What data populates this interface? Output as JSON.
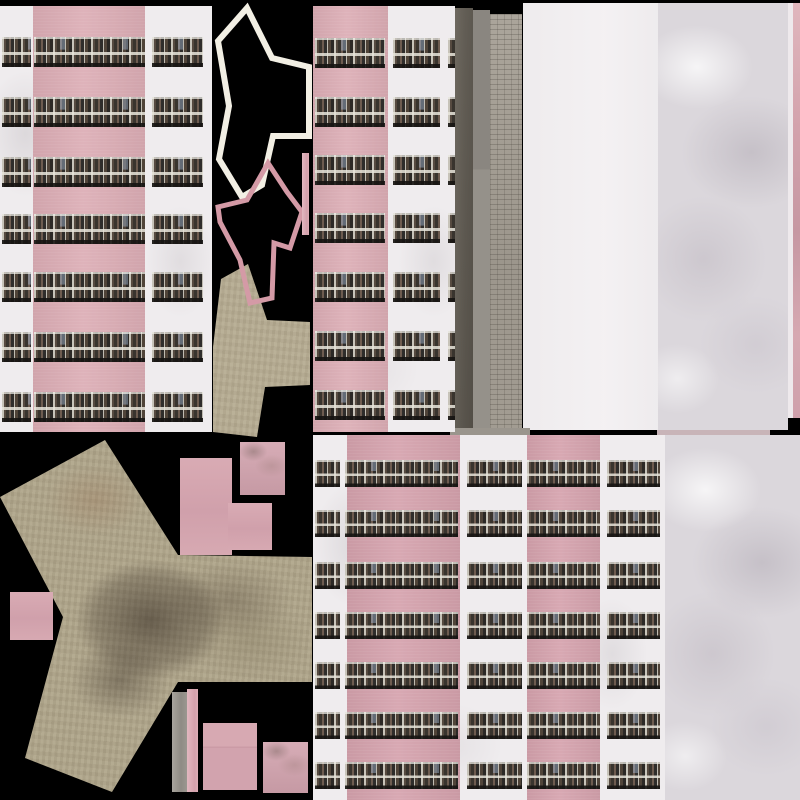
{
  "meta": {
    "description": "Game texture atlas: pink panel-building facades with balcony window strips, Y-shaped roof outline pieces, Y-shaped ground footprint textures, concrete and marble wall panels on black background",
    "atlas_size": {
      "w": 800,
      "h": 800
    }
  },
  "palette": {
    "black_bg": "#000000",
    "pink_wall": "#dcadb5",
    "pink_wall_deep": "#d5a2ad",
    "white_wall": "#efecee",
    "flat_white": "#f3f0f2",
    "marble_base": "#dbd7dc",
    "tan_ground": "#b0a68c",
    "tan_ground_light": "#b6ac93",
    "gray_smooth": "#9b978f",
    "tile_wall": "#a49e94",
    "outline_white": "#f2efe4",
    "outline_pink": "#d49aa6",
    "window_pane": "#38332d",
    "window_frame": "#c7c3b9"
  },
  "ground_shapes": [
    {
      "name": "ground-y-large",
      "cls": "ground big",
      "points": [
        [
          105,
          440
        ],
        [
          178,
          555
        ],
        [
          312,
          557
        ],
        [
          312,
          682
        ],
        [
          178,
          682
        ],
        [
          112,
          792
        ],
        [
          25,
          758
        ],
        [
          63,
          617
        ],
        [
          0,
          497
        ]
      ]
    },
    {
      "name": "ground-y-small",
      "cls": "ground small",
      "points": [
        [
          248,
          264
        ],
        [
          267,
          320
        ],
        [
          310,
          322
        ],
        [
          310,
          385
        ],
        [
          265,
          387
        ],
        [
          257,
          437
        ],
        [
          213,
          432
        ],
        [
          213,
          347
        ],
        [
          221,
          279
        ]
      ]
    }
  ],
  "outline_shapes": [
    {
      "name": "roof-outline-white",
      "stroke": "outline_white",
      "width": 6,
      "points": [
        [
          247,
          8
        ],
        [
          272,
          58
        ],
        [
          309,
          67
        ],
        [
          309,
          136
        ],
        [
          273,
          136
        ],
        [
          262,
          185
        ],
        [
          242,
          197
        ],
        [
          219,
          159
        ],
        [
          229,
          106
        ],
        [
          218,
          41
        ]
      ]
    },
    {
      "name": "roof-outline-pink",
      "stroke": "outline_pink",
      "width": 5,
      "points": [
        [
          268,
          163
        ],
        [
          287,
          192
        ],
        [
          302,
          212
        ],
        [
          290,
          248
        ],
        [
          274,
          243
        ],
        [
          272,
          298
        ],
        [
          250,
          303
        ],
        [
          240,
          260
        ],
        [
          220,
          222
        ],
        [
          218,
          207
        ],
        [
          247,
          200
        ]
      ]
    }
  ],
  "buildings": [
    {
      "name": "facade-left",
      "x": 0,
      "y": 6,
      "w": 212,
      "h": 426,
      "deep": false,
      "pink_bands": [
        {
          "x": 33,
          "w": 112
        }
      ],
      "row_h": 30,
      "row_ys": [
        31,
        91,
        151,
        208,
        266,
        326,
        386
      ],
      "window_strips": [
        {
          "x": 2,
          "w": 29
        },
        {
          "x": 34,
          "w": 111
        },
        {
          "x": 152,
          "w": 51
        }
      ]
    },
    {
      "name": "facade-middle",
      "x": 313,
      "y": 6,
      "w": 142,
      "h": 426,
      "deep": false,
      "pink_bands": [
        {
          "x": 0,
          "w": 75
        }
      ],
      "row_h": 30,
      "row_ys": [
        32,
        91,
        149,
        207,
        266,
        325,
        384
      ],
      "window_strips": [
        {
          "x": 2,
          "w": 70
        },
        {
          "x": 80,
          "w": 47
        },
        {
          "x": 135,
          "w": 7
        }
      ]
    },
    {
      "name": "facade-bottom",
      "x": 313,
      "y": 435,
      "w": 352,
      "h": 365,
      "deep": true,
      "pink_bands": [
        {
          "x": 34,
          "w": 113
        },
        {
          "x": 214,
          "w": 73
        }
      ],
      "row_h": 27,
      "row_ys": [
        25,
        75,
        127,
        177,
        227,
        277,
        327
      ],
      "window_strips": [
        {
          "x": 2,
          "w": 25
        },
        {
          "x": 32,
          "w": 113
        },
        {
          "x": 154,
          "w": 55
        },
        {
          "x": 214,
          "w": 73
        },
        {
          "x": 294,
          "w": 53
        }
      ]
    }
  ],
  "regions": [
    {
      "name": "white-slab-panel",
      "x": 523,
      "y": 3,
      "w": 135,
      "h": 427,
      "cls": "white-slab"
    },
    {
      "name": "marble-panel-top-right",
      "x": 658,
      "y": 3,
      "w": 130,
      "h": 427,
      "cls": "marble"
    },
    {
      "name": "white-sliver-edge",
      "x": 788,
      "y": 3,
      "w": 5,
      "h": 415,
      "cls": "white-sliver"
    },
    {
      "name": "pink-edge-strip",
      "x": 793,
      "y": 3,
      "w": 7,
      "h": 415,
      "cls": "pink-strip-right"
    },
    {
      "name": "gray-strip-smooth",
      "x": 455,
      "y": 8,
      "w": 18,
      "h": 422,
      "cls": "gray-smooth"
    },
    {
      "name": "gray-strip-dark",
      "x": 473,
      "y": 10,
      "w": 17,
      "h": 420,
      "cls": "gray-dark"
    },
    {
      "name": "tiled-wall-strip",
      "x": 490,
      "y": 14,
      "w": 32,
      "h": 416,
      "cls": "tile-wall"
    },
    {
      "name": "pink-bar-vertical",
      "x": 302,
      "y": 153,
      "w": 7,
      "h": 82,
      "cls": "pink-bar"
    },
    {
      "name": "marble-panel-bottom-right",
      "x": 665,
      "y": 435,
      "w": 135,
      "h": 365,
      "cls": "marble"
    },
    {
      "name": "gray-block-top",
      "x": 450,
      "y": 428,
      "w": 80,
      "h": 8,
      "cls": "gray-top"
    },
    {
      "name": "pink-sliver-top",
      "x": 657,
      "y": 430,
      "w": 113,
      "h": 5,
      "cls": "sliver-tr"
    },
    {
      "name": "pink-rect-1",
      "x": 180,
      "y": 458,
      "w": 52,
      "h": 97,
      "cls": "pink-rect"
    },
    {
      "name": "pink-rect-2",
      "x": 240,
      "y": 442,
      "w": 45,
      "h": 53,
      "cls": "pink-rect-m"
    },
    {
      "name": "pink-rect-3",
      "x": 228,
      "y": 503,
      "w": 44,
      "h": 47,
      "cls": "pink-rect"
    },
    {
      "name": "pink-rect-4",
      "x": 10,
      "y": 592,
      "w": 43,
      "h": 48,
      "cls": "pink-rect"
    },
    {
      "name": "gray-bar-bottom",
      "x": 172,
      "y": 692,
      "w": 15,
      "h": 100,
      "cls": "gray-bar"
    },
    {
      "name": "pink-bar-bottom",
      "x": 187,
      "y": 689,
      "w": 11,
      "h": 103,
      "cls": "pink-bar"
    },
    {
      "name": "pink-rect-5",
      "x": 203,
      "y": 723,
      "w": 54,
      "h": 67,
      "cls": "pink-rect-seam"
    },
    {
      "name": "pink-rect-6",
      "x": 263,
      "y": 742,
      "w": 45,
      "h": 51,
      "cls": "pink-rect-m"
    }
  ]
}
